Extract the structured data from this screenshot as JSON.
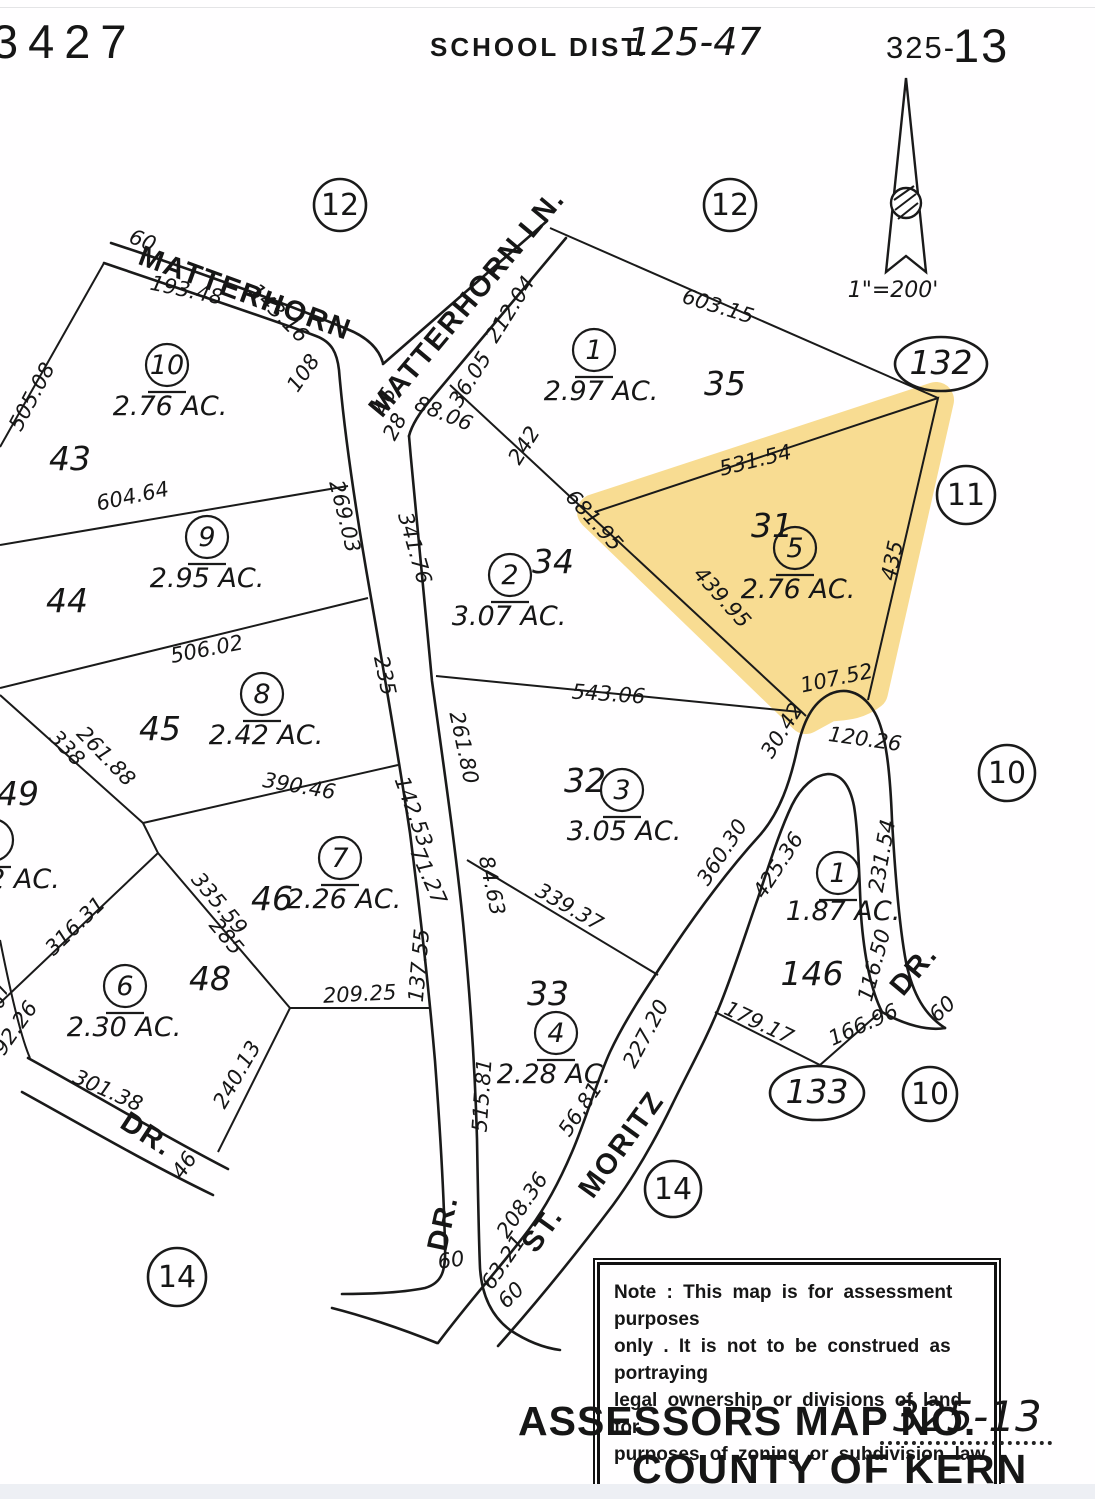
{
  "header": {
    "book_number": "3427",
    "school_label": "SCHOOL DIST.",
    "school_value": "125-47",
    "sheet_small": "325-",
    "sheet_big": "13",
    "scale": "1\"=200'"
  },
  "note": {
    "text": "Note : This map is for assessment purposes\nonly . It is not to be construed as portraying\nlegal ownership or divisions of land for\npurposes of zoning or subdivision law ."
  },
  "title_block": {
    "label": "ASSESSORS MAP NO.",
    "value": "325-13",
    "line2": "COUNTY OF KERN"
  },
  "highlight": {
    "color": "#f6cd5f",
    "opacity": 0.68
  },
  "ink_color": "#1a1a1a",
  "parcels": [
    {
      "num": "10",
      "x": 167,
      "y": 365,
      "ac": "2.76 AC.",
      "acx": 170,
      "acy": 415,
      "lot": "43",
      "lotx": 70,
      "loty": 470
    },
    {
      "num": "9",
      "x": 207,
      "y": 537,
      "ac": "2.95 AC.",
      "acx": 207,
      "acy": 587,
      "lot": "44",
      "lotx": 67,
      "loty": 612
    },
    {
      "num": "8",
      "x": 262,
      "y": 694,
      "ac": "2.42 AC.",
      "acx": 266,
      "acy": 744,
      "lot": "45",
      "lotx": 160,
      "loty": 740
    },
    {
      "num": "7",
      "x": 340,
      "y": 858,
      "ac": "2.26 AC.",
      "acx": 344,
      "acy": 908,
      "lot": "46",
      "lotx": 272,
      "loty": 910
    },
    {
      "num": "6",
      "x": 125,
      "y": 986,
      "ac": "2.30 AC.",
      "acx": 124,
      "acy": 1036,
      "lot": "48",
      "lotx": 210,
      "loty": 990
    },
    {
      "num": "1",
      "x": 594,
      "y": 350,
      "ac": "2.97 AC.",
      "acx": 601,
      "acy": 400,
      "lot": "35",
      "lotx": 725,
      "loty": 395
    },
    {
      "num": "2",
      "x": 510,
      "y": 575,
      "ac": "3.07 AC.",
      "acx": 509,
      "acy": 625,
      "lot": "34",
      "lotx": 553,
      "loty": 573
    },
    {
      "num": "3",
      "x": 622,
      "y": 790,
      "ac": "3.05 AC.",
      "acx": 624,
      "acy": 840,
      "lot": "32",
      "lotx": 585,
      "loty": 792
    },
    {
      "num": "4",
      "x": 556,
      "y": 1033,
      "ac": "2.28 AC.",
      "acx": 554,
      "acy": 1083,
      "lot": "33",
      "lotx": 548,
      "loty": 1005
    },
    {
      "num": "5",
      "x": 795,
      "y": 548,
      "ac": "2.76 AC.",
      "acx": 798,
      "acy": 598,
      "lot": "31",
      "lotx": 772,
      "loty": 537
    },
    {
      "num": "1",
      "x": 838,
      "y": 873,
      "ac": "1.87 AC.",
      "acx": 843,
      "acy": 920,
      "lot": "146",
      "lotx": 812,
      "loty": 985
    },
    {
      "num": "5",
      "x": -8,
      "y": 840,
      "ac": "2 AC.",
      "acx": 24,
      "acy": 888,
      "lot": "49",
      "lotx": 18,
      "loty": 805
    }
  ],
  "ref_circles": [
    {
      "text": "12",
      "x": 340,
      "y": 205,
      "rx": 26,
      "ry": 26,
      "italic": false
    },
    {
      "text": "12",
      "x": 730,
      "y": 205,
      "rx": 26,
      "ry": 26,
      "italic": false
    },
    {
      "text": "132",
      "x": 941,
      "y": 364,
      "rx": 46,
      "ry": 27,
      "italic": true
    },
    {
      "text": "11",
      "x": 966,
      "y": 495,
      "rx": 29,
      "ry": 29,
      "italic": false
    },
    {
      "text": "10",
      "x": 1007,
      "y": 773,
      "rx": 28,
      "ry": 28,
      "italic": false
    },
    {
      "text": "133",
      "x": 817,
      "y": 1093,
      "rx": 47,
      "ry": 27,
      "italic": true
    },
    {
      "text": "10",
      "x": 930,
      "y": 1094,
      "rx": 27,
      "ry": 27,
      "italic": false
    },
    {
      "text": "14",
      "x": 673,
      "y": 1189,
      "rx": 28,
      "ry": 28,
      "italic": false
    },
    {
      "text": "14",
      "x": 177,
      "y": 1277,
      "rx": 29,
      "ry": 29,
      "italic": false
    }
  ],
  "labels": [
    {
      "t": "60",
      "x": 140,
      "y": 247,
      "r": 22,
      "c": "dim"
    },
    {
      "t": "193.48",
      "x": 185,
      "y": 297,
      "r": 12,
      "c": "dim"
    },
    {
      "t": "143.16",
      "x": 274,
      "y": 318,
      "r": 45,
      "c": "dim"
    },
    {
      "t": "505.08",
      "x": 38,
      "y": 400,
      "r": -62,
      "c": "dim"
    },
    {
      "t": "108",
      "x": 309,
      "y": 377,
      "r": -55,
      "c": "dim"
    },
    {
      "t": "212.04",
      "x": 516,
      "y": 313,
      "r": -58,
      "c": "dim"
    },
    {
      "t": "36.05",
      "x": 476,
      "y": 383,
      "r": -58,
      "c": "dim"
    },
    {
      "t": "88.06",
      "x": 441,
      "y": 420,
      "r": 22,
      "c": "dim"
    },
    {
      "t": "28",
      "x": 401,
      "y": 430,
      "r": -62,
      "c": "dim"
    },
    {
      "t": "46",
      "x": 391,
      "y": 404,
      "r": -66,
      "c": "dim"
    },
    {
      "t": "242",
      "x": 530,
      "y": 449,
      "r": -58,
      "c": "dim"
    },
    {
      "t": "603.15",
      "x": 716,
      "y": 313,
      "r": 17,
      "c": "dim"
    },
    {
      "t": "531.54",
      "x": 757,
      "y": 467,
      "r": -14,
      "c": "dim"
    },
    {
      "t": "681.95",
      "x": 589,
      "y": 525,
      "r": 48,
      "c": "dim"
    },
    {
      "t": "439.95",
      "x": 717,
      "y": 602,
      "r": 48,
      "c": "dim"
    },
    {
      "t": "435",
      "x": 899,
      "y": 562,
      "r": -78,
      "c": "dim"
    },
    {
      "t": "107.52",
      "x": 838,
      "y": 685,
      "r": -12,
      "c": "dim"
    },
    {
      "t": "30.42",
      "x": 788,
      "y": 734,
      "r": -58,
      "c": "dim"
    },
    {
      "t": "120.26",
      "x": 864,
      "y": 746,
      "r": 8,
      "c": "dim"
    },
    {
      "t": "543.06",
      "x": 608,
      "y": 701,
      "r": 4,
      "c": "dim"
    },
    {
      "t": "341.76",
      "x": 408,
      "y": 550,
      "r": 74,
      "c": "dim"
    },
    {
      "t": "269.03",
      "x": 338,
      "y": 518,
      "r": 76,
      "c": "dim"
    },
    {
      "t": "235",
      "x": 378,
      "y": 677,
      "r": 78,
      "c": "dim"
    },
    {
      "t": "261.80",
      "x": 457,
      "y": 749,
      "r": 78,
      "c": "dim"
    },
    {
      "t": "142.53",
      "x": 407,
      "y": 814,
      "r": 70,
      "c": "dim"
    },
    {
      "t": "71.27",
      "x": 422,
      "y": 879,
      "r": 66,
      "c": "dim"
    },
    {
      "t": "84.63",
      "x": 485,
      "y": 887,
      "r": 78,
      "c": "dim"
    },
    {
      "t": "339.37",
      "x": 566,
      "y": 913,
      "r": 30,
      "c": "dim"
    },
    {
      "t": "506.02",
      "x": 208,
      "y": 656,
      "r": -11,
      "c": "dim"
    },
    {
      "t": "604.64",
      "x": 134,
      "y": 503,
      "r": -12,
      "c": "dim"
    },
    {
      "t": "390.46",
      "x": 298,
      "y": 793,
      "r": 10,
      "c": "dim"
    },
    {
      "t": "338",
      "x": 62,
      "y": 753,
      "r": 46,
      "c": "dim"
    },
    {
      "t": "261.88",
      "x": 101,
      "y": 761,
      "r": 46,
      "c": "dim"
    },
    {
      "t": "316.31",
      "x": 80,
      "y": 931,
      "r": -44,
      "c": "dim"
    },
    {
      "t": "335.59",
      "x": 214,
      "y": 908,
      "r": 50,
      "c": "dim"
    },
    {
      "t": "285",
      "x": 221,
      "y": 941,
      "r": 50,
      "c": "dim"
    },
    {
      "t": "209.25",
      "x": 360,
      "y": 1001,
      "r": -3,
      "c": "dim"
    },
    {
      "t": "240.13",
      "x": 243,
      "y": 1078,
      "r": -60,
      "c": "dim"
    },
    {
      "t": "301.38",
      "x": 105,
      "y": 1097,
      "r": 24,
      "c": "dim"
    },
    {
      "t": "46",
      "x": 190,
      "y": 1169,
      "r": -55,
      "c": "dim"
    },
    {
      "t": "92.26",
      "x": 21,
      "y": 1032,
      "r": -55,
      "c": "dim"
    },
    {
      "t": "07",
      "x": 6,
      "y": 997,
      "r": -75,
      "c": "dim"
    },
    {
      "t": "137.55",
      "x": 426,
      "y": 966,
      "r": -85,
      "c": "dim"
    },
    {
      "t": "515.81",
      "x": 489,
      "y": 1096,
      "r": -86,
      "c": "dim"
    },
    {
      "t": "60",
      "x": 452,
      "y": 1267,
      "r": -8,
      "c": "dim"
    },
    {
      "t": "208.36",
      "x": 528,
      "y": 1209,
      "r": -56,
      "c": "dim"
    },
    {
      "t": "63.21",
      "x": 509,
      "y": 1266,
      "r": -56,
      "c": "dim"
    },
    {
      "t": "60",
      "x": 516,
      "y": 1300,
      "r": -45,
      "c": "dim"
    },
    {
      "t": "56.81",
      "x": 586,
      "y": 1113,
      "r": -56,
      "c": "dim"
    },
    {
      "t": "227.20",
      "x": 652,
      "y": 1037,
      "r": -62,
      "c": "dim"
    },
    {
      "t": "360.30",
      "x": 728,
      "y": 856,
      "r": -57,
      "c": "dim"
    },
    {
      "t": "425.36",
      "x": 784,
      "y": 869,
      "r": -57,
      "c": "dim"
    },
    {
      "t": "231.54",
      "x": 889,
      "y": 857,
      "r": -80,
      "c": "dim"
    },
    {
      "t": "116.50",
      "x": 881,
      "y": 967,
      "r": -75,
      "c": "dim"
    },
    {
      "t": "60",
      "x": 947,
      "y": 1014,
      "r": -42,
      "c": "dim"
    },
    {
      "t": "166.96",
      "x": 866,
      "y": 1031,
      "r": -24,
      "c": "dim"
    },
    {
      "t": "179.17",
      "x": 756,
      "y": 1029,
      "r": 25,
      "c": "dim"
    },
    {
      "t": "MATTERHORN",
      "x": 242,
      "y": 302,
      "r": 20,
      "c": "street"
    },
    {
      "t": "MATTERHORN  LN.",
      "x": 474,
      "y": 309,
      "r": -50,
      "c": "street"
    },
    {
      "t": "DR.",
      "x": 142,
      "y": 1142,
      "r": 33,
      "c": "street"
    },
    {
      "t": "DR.",
      "x": 452,
      "y": 1225,
      "r": -78,
      "c": "street"
    },
    {
      "t": "ST.",
      "x": 550,
      "y": 1235,
      "r": -54,
      "c": "street"
    },
    {
      "t": "MORITZ",
      "x": 629,
      "y": 1150,
      "r": -54,
      "c": "street"
    },
    {
      "t": "DR.",
      "x": 921,
      "y": 976,
      "r": -50,
      "c": "street"
    }
  ]
}
